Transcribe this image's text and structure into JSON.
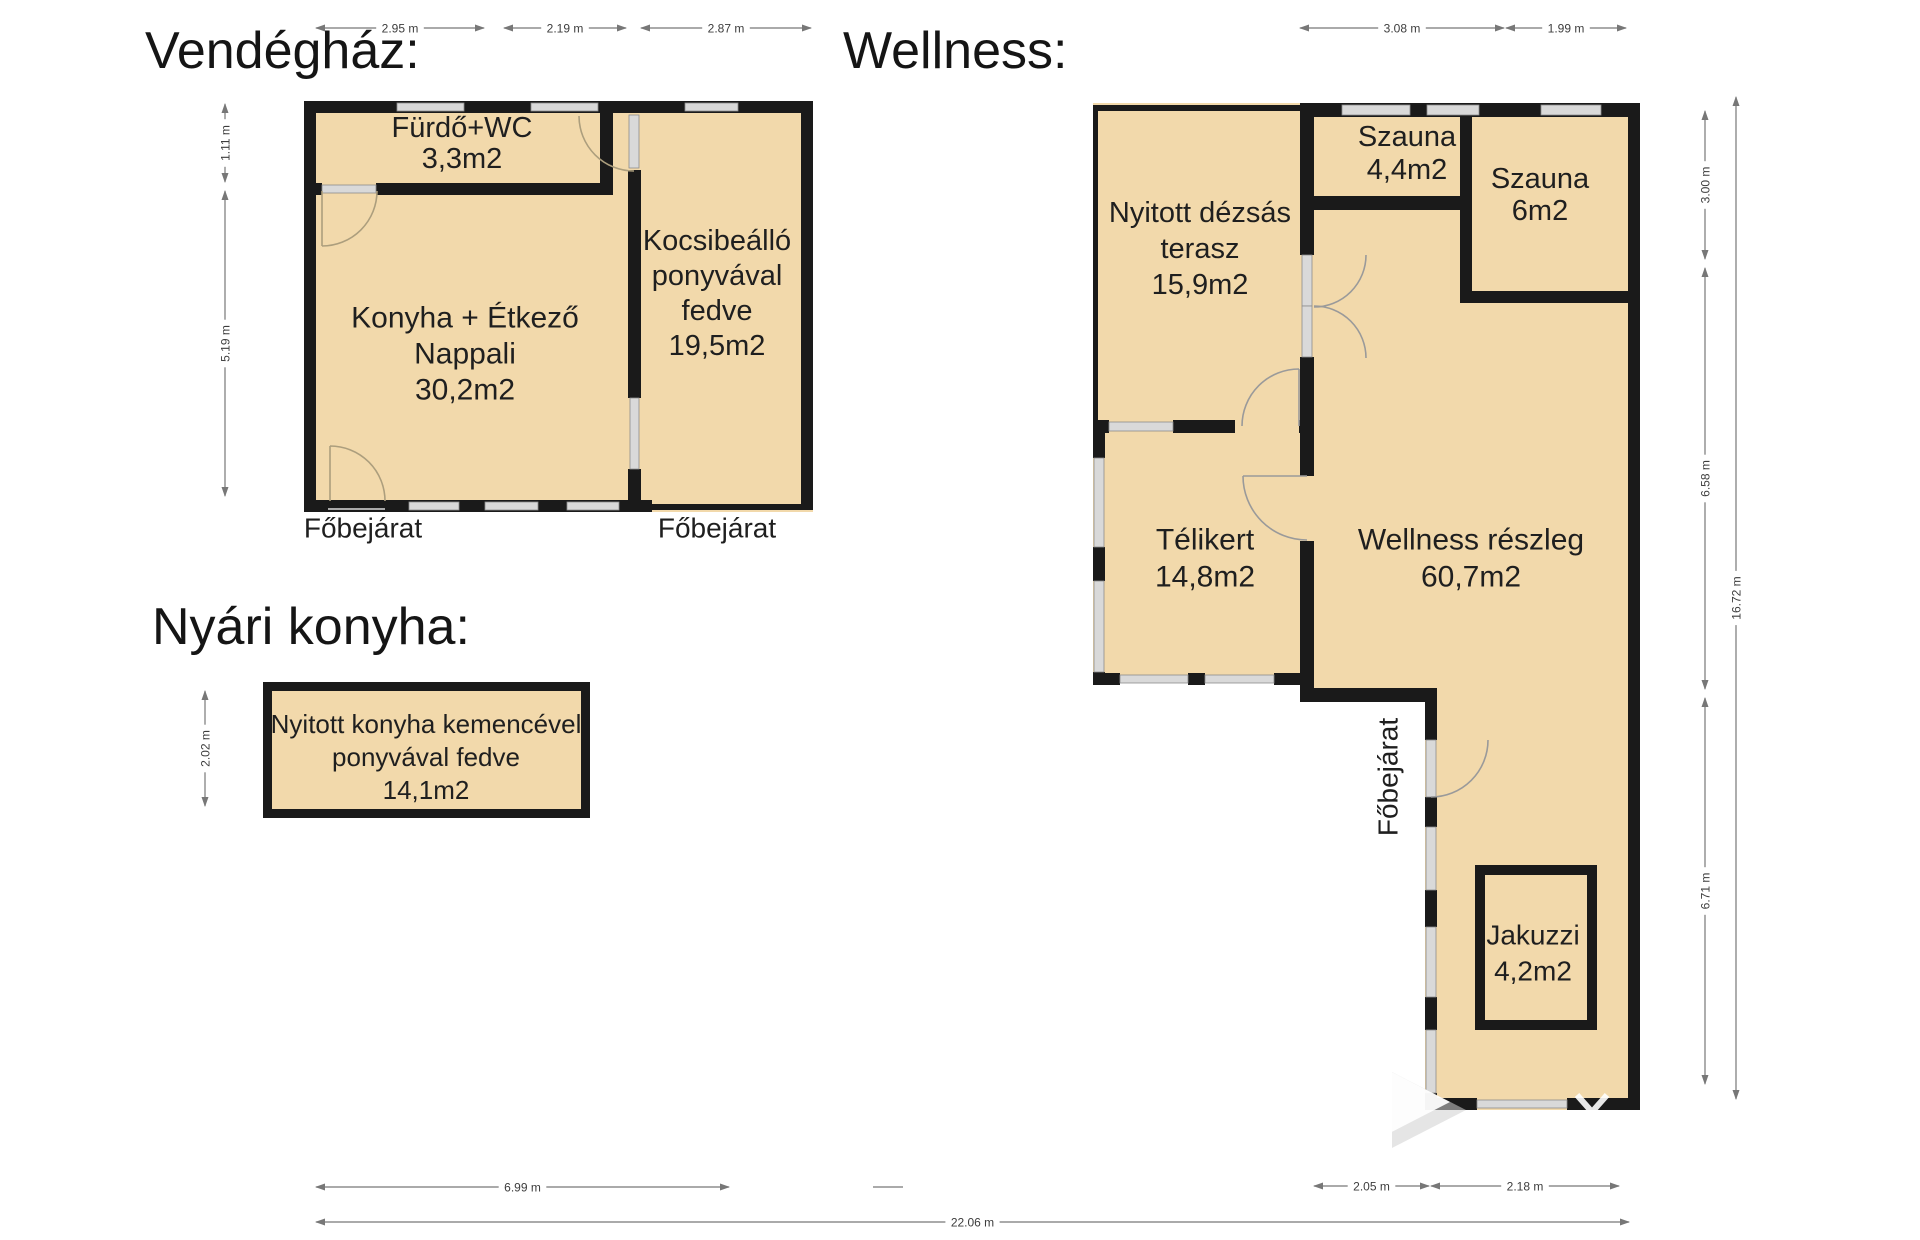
{
  "titles": {
    "vendeghaz": "Vendégház:",
    "wellness": "Wellness:",
    "nyari_konyha": "Nyári konyha:"
  },
  "palette": {
    "background": "#ffffff",
    "room_fill": "#F2D9AB",
    "wall": "#1A1A1A",
    "window_fill": "#D9D9D9",
    "window_border": "#8C8C8C",
    "door_stroke_house": "#AC9E7D",
    "door_stroke_wellness": "#9A9A9A",
    "dim_line": "#777777",
    "dim_text": "#3D3D3D",
    "label_color": "#1F1F1F"
  },
  "floorplan": {
    "fills": [
      {
        "id": "vendeghaz-fill",
        "points": "304,101 813,101 813,512 304,512"
      },
      {
        "id": "wellness-fill",
        "points": "1093,103 1640,103 1640,1110 1425,1110 1425,700 1300,700 1300,683 1093,683"
      },
      {
        "id": "nyari-box-outer",
        "points": "263,682 590,682 590,818 263,818",
        "fill_key": "wall"
      }
    ],
    "fills_top": [
      {
        "id": "nyari-box-inner",
        "x": 272,
        "y": 691,
        "w": 309,
        "h": 118
      },
      {
        "id": "jakuzzi-inner",
        "x": 1485,
        "y": 875,
        "w": 102,
        "h": 145
      }
    ],
    "walls": [
      {
        "id": "vh-top",
        "x": 304,
        "y": 101,
        "w": 509,
        "h": 12
      },
      {
        "id": "vh-left",
        "x": 304,
        "y": 101,
        "w": 12,
        "h": 411
      },
      {
        "id": "vh-bottom",
        "x": 304,
        "y": 500,
        "w": 348,
        "h": 12
      },
      {
        "id": "vh-right",
        "x": 801,
        "y": 101,
        "w": 12,
        "h": 408
      },
      {
        "id": "vh-carport-bottom",
        "x": 648,
        "y": 504,
        "w": 165,
        "h": 6
      },
      {
        "id": "vh-interior-1",
        "x": 628,
        "y": 170,
        "w": 13,
        "h": 228
      },
      {
        "id": "vh-interior-2",
        "x": 628,
        "y": 469,
        "w": 13,
        "h": 43
      },
      {
        "id": "vh-furdo-right",
        "x": 600,
        "y": 101,
        "w": 13,
        "h": 94
      },
      {
        "id": "vh-furdo-bottom",
        "x": 376,
        "y": 183,
        "w": 237,
        "h": 12
      },
      {
        "id": "vh-furdo-bottom-left",
        "x": 304,
        "y": 183,
        "w": 18,
        "h": 12
      },
      {
        "id": "wl-top-thin",
        "x": 1093,
        "y": 105,
        "w": 210,
        "h": 6
      },
      {
        "id": "wl-top-thick",
        "x": 1300,
        "y": 103,
        "w": 340,
        "h": 14
      },
      {
        "id": "wl-terasz-left-thin",
        "x": 1093,
        "y": 105,
        "w": 5,
        "h": 317
      },
      {
        "id": "wl-telikert-left-1",
        "x": 1093,
        "y": 420,
        "w": 12,
        "h": 38
      },
      {
        "id": "wl-telikert-left-2",
        "x": 1093,
        "y": 547,
        "w": 12,
        "h": 34
      },
      {
        "id": "wl-telikert-left-3",
        "x": 1093,
        "y": 672,
        "w": 12,
        "h": 13
      },
      {
        "id": "wl-terasz-bottom-1",
        "x": 1093,
        "y": 420,
        "w": 16,
        "h": 13
      },
      {
        "id": "wl-terasz-bottom-2",
        "x": 1173,
        "y": 420,
        "w": 62,
        "h": 13
      },
      {
        "id": "wl-terasz-bottom-3",
        "x": 1299,
        "y": 420,
        "w": 15,
        "h": 13
      },
      {
        "id": "wl-divider-upper",
        "x": 1300,
        "y": 103,
        "w": 14,
        "h": 152
      },
      {
        "id": "wl-divider-mid",
        "x": 1300,
        "y": 357,
        "w": 14,
        "h": 63
      },
      {
        "id": "wl-szauna44-bottom",
        "x": 1300,
        "y": 196,
        "w": 172,
        "h": 14
      },
      {
        "id": "wl-szauna6-left",
        "x": 1460,
        "y": 103,
        "w": 12,
        "h": 200
      },
      {
        "id": "wl-szauna6-bottom",
        "x": 1460,
        "y": 291,
        "w": 180,
        "h": 12
      },
      {
        "id": "wl-right",
        "x": 1628,
        "y": 103,
        "w": 12,
        "h": 1007
      },
      {
        "id": "wl-telikert-bottom-1",
        "x": 1093,
        "y": 673,
        "w": 27,
        "h": 12
      },
      {
        "id": "wl-telikert-bottom-2",
        "x": 1188,
        "y": 673,
        "w": 17,
        "h": 12
      },
      {
        "id": "wl-telikert-bottom-3",
        "x": 1274,
        "y": 673,
        "w": 40,
        "h": 12
      },
      {
        "id": "wl-telikert-right-1",
        "x": 1300,
        "y": 433,
        "w": 14,
        "h": 43
      },
      {
        "id": "wl-telikert-right-2",
        "x": 1300,
        "y": 541,
        "w": 14,
        "h": 159
      },
      {
        "id": "wl-step",
        "x": 1300,
        "y": 688,
        "w": 137,
        "h": 14
      },
      {
        "id": "wl-lower-left-1",
        "x": 1425,
        "y": 700,
        "w": 12,
        "h": 40
      },
      {
        "id": "wl-lower-left-2",
        "x": 1425,
        "y": 797,
        "w": 12,
        "h": 30
      },
      {
        "id": "wl-lower-left-3",
        "x": 1425,
        "y": 890,
        "w": 12,
        "h": 37
      },
      {
        "id": "wl-lower-left-4",
        "x": 1425,
        "y": 997,
        "w": 12,
        "h": 33
      },
      {
        "id": "wl-lower-left-5",
        "x": 1425,
        "y": 1093,
        "w": 12,
        "h": 17
      },
      {
        "id": "wl-bottom-1",
        "x": 1425,
        "y": 1098,
        "w": 52,
        "h": 12
      },
      {
        "id": "wl-bottom-2",
        "x": 1567,
        "y": 1098,
        "w": 73,
        "h": 12
      },
      {
        "id": "jakuzzi-outer",
        "x": 1475,
        "y": 865,
        "w": 122,
        "h": 165
      }
    ],
    "windows": [
      {
        "id": "vh-top-window-1",
        "x": 397,
        "y": 103,
        "w": 67,
        "h": 8
      },
      {
        "id": "vh-top-window-2",
        "x": 531,
        "y": 103,
        "w": 67,
        "h": 8
      },
      {
        "id": "vh-carport-top-window",
        "x": 685,
        "y": 103,
        "w": 53,
        "h": 8
      },
      {
        "id": "vh-bottom-window-1",
        "x": 409,
        "y": 502,
        "w": 50,
        "h": 8
      },
      {
        "id": "vh-bottom-window-2",
        "x": 485,
        "y": 502,
        "w": 53,
        "h": 8
      },
      {
        "id": "vh-bottom-window-3",
        "x": 567,
        "y": 502,
        "w": 52,
        "h": 8
      },
      {
        "id": "vh-interior-window",
        "x": 630,
        "y": 398,
        "w": 9,
        "h": 71
      },
      {
        "id": "wl-top-window-1",
        "x": 1342,
        "y": 105,
        "w": 68,
        "h": 10
      },
      {
        "id": "wl-top-window-2",
        "x": 1427,
        "y": 105,
        "w": 52,
        "h": 10
      },
      {
        "id": "wl-top-window-3",
        "x": 1541,
        "y": 105,
        "w": 60,
        "h": 10
      },
      {
        "id": "wl-telikert-left-window-1",
        "x": 1094,
        "y": 458,
        "w": 10,
        "h": 89
      },
      {
        "id": "wl-telikert-left-window-2",
        "x": 1094,
        "y": 581,
        "w": 10,
        "h": 91
      },
      {
        "id": "wl-terasz-bottom-window",
        "x": 1109,
        "y": 422,
        "w": 64,
        "h": 9
      },
      {
        "id": "wl-telikert-bottom-window-1",
        "x": 1120,
        "y": 675,
        "w": 68,
        "h": 8
      },
      {
        "id": "wl-telikert-bottom-window-2",
        "x": 1205,
        "y": 675,
        "w": 69,
        "h": 8
      },
      {
        "id": "wl-lower-left-window-1",
        "x": 1426,
        "y": 827,
        "w": 10,
        "h": 63
      },
      {
        "id": "wl-lower-left-window-2",
        "x": 1426,
        "y": 927,
        "w": 10,
        "h": 70
      },
      {
        "id": "wl-lower-left-window-3",
        "x": 1426,
        "y": 1030,
        "w": 10,
        "h": 63
      },
      {
        "id": "wl-bottom-window",
        "x": 1477,
        "y": 1100,
        "w": 90,
        "h": 8
      }
    ],
    "door_leaves": [
      {
        "id": "vh-furdo-door-leaf",
        "x": 322,
        "y": 185,
        "w": 54,
        "h": 8
      },
      {
        "id": "vh-interior-door-leaf",
        "x": 629,
        "y": 115,
        "w": 10,
        "h": 53
      },
      {
        "id": "wl-double-door-leaf-1",
        "x": 1302,
        "y": 255,
        "w": 10,
        "h": 51
      },
      {
        "id": "wl-double-door-leaf-2",
        "x": 1302,
        "y": 306,
        "w": 10,
        "h": 51
      },
      {
        "id": "wl-fobejarat-door-leaf",
        "x": 1426,
        "y": 740,
        "w": 10,
        "h": 57
      }
    ],
    "door_arcs": [
      {
        "id": "vh-furdo-door-arc",
        "stroke_key": "door_stroke_house",
        "d": "M 322,191 L 322,246 M 377,191 A 55 55 0 0 1 322,246"
      },
      {
        "id": "vh-entrance-door-arc",
        "stroke_key": "door_stroke_house",
        "d": "M 330,501 L 330,446 M 330,446 A 55 55 0 0 1 385,501"
      },
      {
        "id": "vh-interior-door-arc",
        "stroke_key": "door_stroke_house",
        "d": "M 579,116 A 55 55 0 0 0 634,171"
      },
      {
        "id": "wl-double-door-arc-top",
        "stroke_key": "door_stroke_wellness",
        "d": "M 1366,255 A 52 52 0 0 1 1314,307"
      },
      {
        "id": "wl-double-door-arc-bottom",
        "stroke_key": "door_stroke_wellness",
        "d": "M 1314,306 A 52 52 0 0 1 1366,358"
      },
      {
        "id": "wl-terasz-door-arc",
        "stroke_key": "door_stroke_wellness",
        "d": "M 1299,369 L 1299,426 M 1242,426 A 57 57 0 0 1 1299,369"
      },
      {
        "id": "wl-telikert-door-arc",
        "stroke_key": "door_stroke_wellness",
        "d": "M 1243,476 L 1307,476 M 1243,476 A 64 64 0 0 0 1307,540"
      },
      {
        "id": "wl-fobejarat-door-arc",
        "stroke_key": "door_stroke_wellness",
        "d": "M 1431,797 A 57 57 0 0 0 1488,740"
      }
    ],
    "sills": [
      {
        "id": "vh-entrance-sill",
        "x1": 328,
        "y1": 509,
        "x2": 385,
        "y2": 509
      }
    ],
    "room_labels": [
      {
        "id": "furdo-wc",
        "cx": 462,
        "y": 128,
        "lh": 31,
        "size": 29,
        "lines": [
          "Fürdő+WC",
          "3,3m2"
        ]
      },
      {
        "id": "konyha-etkezo",
        "cx": 465,
        "y": 318,
        "lh": 36,
        "size": 30,
        "lines": [
          "Konyha + Étkező",
          "Nappali",
          "30,2m2"
        ]
      },
      {
        "id": "kocsibeallo",
        "cx": 717,
        "y": 241,
        "lh": 35,
        "size": 29,
        "lines": [
          "Kocsibeálló",
          "ponyvával",
          "fedve",
          "19,5m2"
        ]
      },
      {
        "id": "nyitott-konyha",
        "cx": 426,
        "y": 724,
        "lh": 33,
        "size": 26,
        "lines": [
          "Nyitott konyha kemencével",
          "ponyvával fedve",
          "14,1m2"
        ]
      },
      {
        "id": "nyitott-dezsas-terasz",
        "cx": 1200,
        "y": 213,
        "lh": 36,
        "size": 29,
        "lines": [
          "Nyitott dézsás",
          "terasz",
          "15,9m2"
        ]
      },
      {
        "id": "szauna-44",
        "cx": 1407,
        "y": 137,
        "lh": 33,
        "size": 29,
        "lines": [
          "Szauna",
          "4,4m2"
        ]
      },
      {
        "id": "szauna-6",
        "cx": 1540,
        "y": 179,
        "lh": 32,
        "size": 29,
        "lines": [
          "Szauna",
          "6m2"
        ]
      },
      {
        "id": "telikert",
        "cx": 1205,
        "y": 540,
        "lh": 37,
        "size": 30,
        "lines": [
          "Télikert",
          "14,8m2"
        ]
      },
      {
        "id": "wellness-reszleg",
        "cx": 1471,
        "y": 540,
        "lh": 37,
        "size": 30,
        "lines": [
          "Wellness részleg",
          "60,7m2"
        ]
      },
      {
        "id": "jakuzzi",
        "cx": 1533,
        "y": 935,
        "lh": 36,
        "size": 28,
        "lines": [
          "Jakuzzi",
          "4,2m2"
        ]
      }
    ],
    "annotations": [
      {
        "id": "fobejarat-house-left",
        "text": "Főbejárat",
        "x": 363,
        "y": 528,
        "size": 28,
        "rotate": 0
      },
      {
        "id": "fobejarat-house-right",
        "text": "Főbejárat",
        "x": 717,
        "y": 528,
        "size": 28,
        "rotate": 0
      },
      {
        "id": "fobejarat-wellness",
        "text": "Főbejárat",
        "x": 1388,
        "y": 777,
        "size": 28,
        "rotate": -90
      }
    ],
    "dims": {
      "h": [
        {
          "x1": 315,
          "x2": 485,
          "y": 28,
          "label": "2.95 m"
        },
        {
          "x1": 503,
          "x2": 627,
          "y": 28,
          "label": "2.19 m"
        },
        {
          "x1": 640,
          "x2": 812,
          "y": 28,
          "label": "2.87 m"
        },
        {
          "x1": 1299,
          "x2": 1505,
          "y": 28,
          "label": "3.08 m"
        },
        {
          "x1": 1505,
          "x2": 1627,
          "y": 28,
          "label": "1.99 m"
        },
        {
          "x1": 315,
          "x2": 730,
          "y": 1187,
          "label": "6.99 m"
        },
        {
          "x1": 1313,
          "x2": 1430,
          "y": 1186,
          "label": "2.05 m"
        },
        {
          "x1": 1430,
          "x2": 1620,
          "y": 1186,
          "label": "2.18 m"
        },
        {
          "x1": 315,
          "x2": 1630,
          "y": 1222,
          "label": "22.06 m"
        }
      ],
      "v": [
        {
          "x": 225,
          "y1": 103,
          "y2": 183,
          "label": "1.11 m"
        },
        {
          "x": 225,
          "y1": 190,
          "y2": 497,
          "label": "5.19 m"
        },
        {
          "x": 205,
          "y1": 690,
          "y2": 807,
          "label": "2.02 m"
        },
        {
          "x": 1705,
          "y1": 110,
          "y2": 260,
          "label": "3.00 m"
        },
        {
          "x": 1705,
          "y1": 267,
          "y2": 690,
          "label": "6.58 m"
        },
        {
          "x": 1705,
          "y1": 697,
          "y2": 1085,
          "label": "6.71 m"
        },
        {
          "x": 1736,
          "y1": 96,
          "y2": 1100,
          "label": "16.72 m"
        }
      ],
      "extra_lines": [
        {
          "x1": 873,
          "y1": 1187,
          "x2": 903,
          "y2": 1187
        }
      ]
    },
    "watermark": {
      "triangles": [
        {
          "id": "watermark-shadow-triangle",
          "points": "1392,1072 1392,1148 1466,1110",
          "fill": "#cfcfcf",
          "opacity": 0.55
        },
        {
          "id": "watermark-triangle",
          "points": "1376,1064 1376,1140 1450,1102",
          "fill": "#ffffff",
          "opacity": 0.92
        }
      ],
      "strokes": [
        {
          "id": "watermark-v-mark",
          "d": "M 1577,1095 L 1592,1112 L 1607,1095",
          "stroke": "#ffffff",
          "width": 6,
          "opacity": 0.9
        }
      ]
    }
  }
}
